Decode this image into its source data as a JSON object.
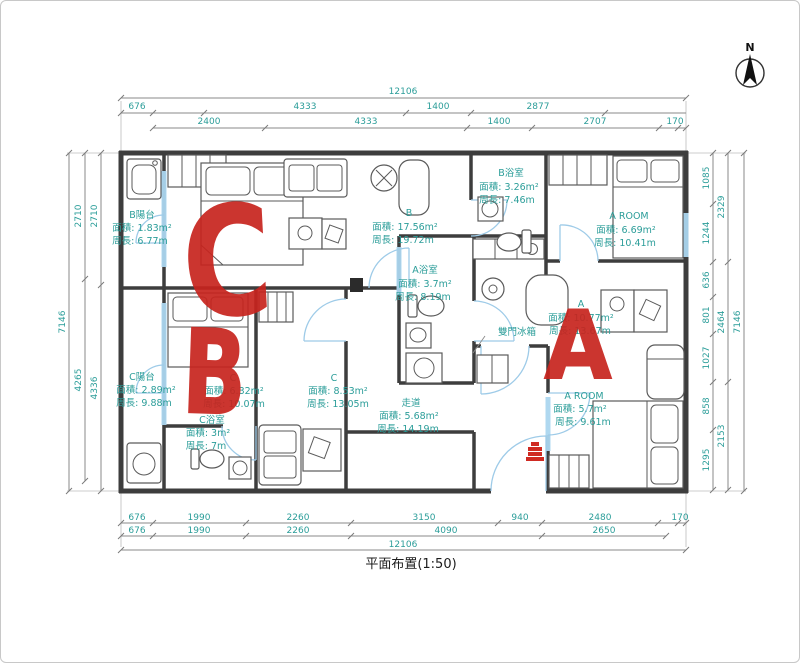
{
  "title": "平面布置(1:50)",
  "compass": {
    "label": "N"
  },
  "annotations": {
    "letter_c": "C",
    "letter_b": "B",
    "letter_a": "A"
  },
  "fridge_label": "雙門冰箱",
  "colors": {
    "dimension_text": "#2b9d99",
    "dimension_line": "#8a8a8a",
    "wall": "#3d3d3d",
    "window_highlight": "#abd6ef",
    "door_arc": "#9ecbe8",
    "annotation_red": "#c7241e"
  },
  "rooms": {
    "b_balcony": {
      "name": "B陽台",
      "area": "面積: 1.83m²",
      "perimeter": "周長: 6.77m"
    },
    "room_b": {
      "name": "B",
      "area": "面積: 17.56m²",
      "perimeter": "周長: 19.72m"
    },
    "b_bath": {
      "name": "B浴室",
      "area": "面積: 3.26m²",
      "perimeter": "周長: 7.46m"
    },
    "a_room_top": {
      "name": "A ROOM",
      "area": "面積: 6.69m²",
      "perimeter": "周長: 10.41m"
    },
    "a_bath": {
      "name": "A浴室",
      "area": "面積: 3.7m²",
      "perimeter": "周長: 8.19m"
    },
    "room_a": {
      "name": "A",
      "area": "面積: 10.77m²",
      "perimeter": "周長: 13.67m"
    },
    "c_balcony": {
      "name": "C陽台",
      "area": "面積: 2.89m²",
      "perimeter": "周長: 9.88m"
    },
    "room_c_left": {
      "name": "C",
      "area": "面積: 6.32m²",
      "perimeter": "周長: 10.07m"
    },
    "room_c_right": {
      "name": "C",
      "area": "面積: 8.53m²",
      "perimeter": "周長: 13.05m"
    },
    "corridor": {
      "name": "走道",
      "area": "面積: 5.68m²",
      "perimeter": "周長: 14.19m"
    },
    "c_bath": {
      "name": "C浴室",
      "area": "面積: 3m²",
      "perimeter": "周長: 7m"
    },
    "a_room_bottom": {
      "name": "A ROOM",
      "area": "面積: 5.7m²",
      "perimeter": "周長: 9.61m"
    }
  },
  "dimensions": {
    "top": {
      "row1": [
        "12106"
      ],
      "row2": [
        "676",
        "4333",
        "1400",
        "2877"
      ],
      "row3": [
        "2400",
        "4333",
        "1400",
        "2707",
        "170"
      ]
    },
    "bottom": {
      "row1": [
        "676",
        "1990",
        "2260",
        "3150",
        "940",
        "2480",
        "170"
      ],
      "row2": [
        "676",
        "1990",
        "2260",
        "4090",
        "2650"
      ],
      "row3": [
        "12106"
      ]
    },
    "left": {
      "outer": "7146",
      "col_mid": [
        "2710",
        "4265"
      ],
      "col_inner": [
        "2710",
        "4336"
      ]
    },
    "right": {
      "col_inner": [
        "1085",
        "1244",
        "636",
        "801",
        "1027",
        "858",
        "1295"
      ],
      "col_mid": [
        "2329",
        "2464",
        "2153"
      ],
      "outer": "7146"
    }
  }
}
